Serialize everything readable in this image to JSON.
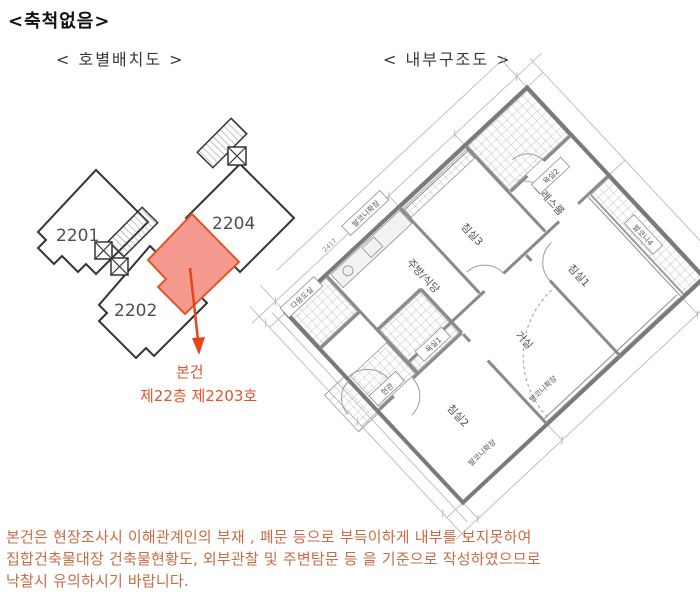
{
  "header": {
    "scale_note": "<축척없음>",
    "unit_layout_title": "< 호별배치도 >",
    "internal_structure_title": "< 내부구조도 >"
  },
  "unit_plan": {
    "unit_2201": "2201",
    "unit_2202": "2202",
    "unit_2204": "2204",
    "highlight_fill": "#f59a8e",
    "highlight_stroke": "#e2552b",
    "callout_color": "#e0532e",
    "callout_line1": "본건",
    "callout_line2": "제22층 제2203호"
  },
  "floor_plan": {
    "labels": {
      "bedroom1": "침실1",
      "bedroom2": "침실2",
      "bedroom3": "침실3",
      "living_room": "거실",
      "kitchen_dining": "주방/식당",
      "entrance": "현관",
      "bathroom1": "욕실1",
      "bathroom2": "욕실2",
      "dress_room": "드레스룸",
      "utility_room": "다용도실",
      "balcony_extension_top": "발코니확장",
      "balcony_extension_bottom1": "발코니확장",
      "balcony_extension_bottom2": "발코니확장",
      "balcony4": "발코니4",
      "dimension": "2417"
    }
  },
  "footer": {
    "color": "#c96b45",
    "lines": [
      "본건은 현장조사시 이해관계인의  부재 , 폐문 등으로 부득이하게 내부를 보지못하여",
      "집합건축물대장 건축물현황도, 외부관찰 및 주변탐문 등 을 기준으로 작성하였으므로",
      "낙찰시 유의하시기 바랍니다."
    ]
  }
}
